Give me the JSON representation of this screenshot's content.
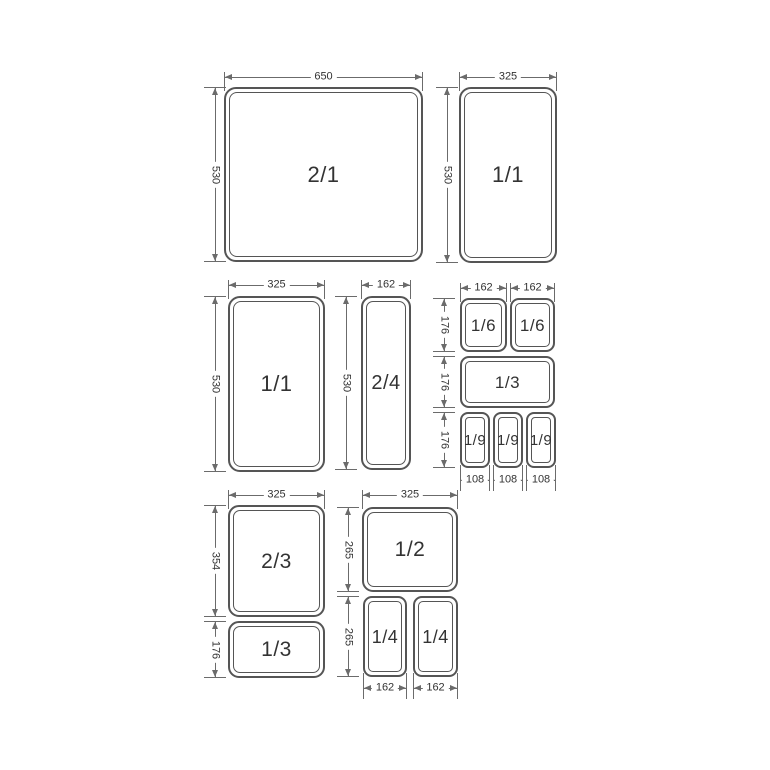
{
  "canvas": {
    "width": 770,
    "height": 770,
    "background": "#ffffff"
  },
  "style": {
    "pan_line_color": "#555555",
    "pan_text_color": "#333333",
    "dim_line_color": "#6b6b6b",
    "dim_text_color": "#333333"
  },
  "pans": [
    {
      "id": "pan-2-1",
      "label": "2/1",
      "x": 224,
      "y": 87,
      "w": 199,
      "h": 175,
      "fs": 22,
      "r": 12
    },
    {
      "id": "pan-1-1-top",
      "label": "1/1",
      "x": 459,
      "y": 87,
      "w": 98,
      "h": 176,
      "fs": 22,
      "r": 12
    },
    {
      "id": "pan-1-1-mid",
      "label": "1/1",
      "x": 228,
      "y": 296,
      "w": 97,
      "h": 176,
      "fs": 22,
      "r": 12
    },
    {
      "id": "pan-2-4",
      "label": "2/4",
      "x": 361,
      "y": 296,
      "w": 50,
      "h": 174,
      "fs": 20,
      "r": 11
    },
    {
      "id": "pan-1-6-a",
      "label": "1/6",
      "x": 460,
      "y": 298,
      "w": 47,
      "h": 54,
      "fs": 17,
      "r": 9
    },
    {
      "id": "pan-1-6-b",
      "label": "1/6",
      "x": 510,
      "y": 298,
      "w": 45,
      "h": 54,
      "fs": 17,
      "r": 9
    },
    {
      "id": "pan-1-3-group",
      "label": "1/3",
      "x": 460,
      "y": 356,
      "w": 95,
      "h": 52,
      "fs": 17,
      "r": 9
    },
    {
      "id": "pan-1-9-a",
      "label": "1/9",
      "x": 460,
      "y": 412,
      "w": 30,
      "h": 56,
      "fs": 15,
      "r": 8
    },
    {
      "id": "pan-1-9-b",
      "label": "1/9",
      "x": 493,
      "y": 412,
      "w": 30,
      "h": 56,
      "fs": 15,
      "r": 8
    },
    {
      "id": "pan-1-9-c",
      "label": "1/9",
      "x": 526,
      "y": 412,
      "w": 30,
      "h": 56,
      "fs": 15,
      "r": 8
    },
    {
      "id": "pan-2-3",
      "label": "2/3",
      "x": 228,
      "y": 505,
      "w": 97,
      "h": 112,
      "fs": 21,
      "r": 11
    },
    {
      "id": "pan-1-3-bottom",
      "label": "1/3",
      "x": 228,
      "y": 621,
      "w": 97,
      "h": 57,
      "fs": 21,
      "r": 11
    },
    {
      "id": "pan-1-2",
      "label": "1/2",
      "x": 362,
      "y": 507,
      "w": 96,
      "h": 85,
      "fs": 21,
      "r": 11
    },
    {
      "id": "pan-1-4-a",
      "label": "1/4",
      "x": 363,
      "y": 596,
      "w": 44,
      "h": 81,
      "fs": 18,
      "r": 9
    },
    {
      "id": "pan-1-4-b",
      "label": "1/4",
      "x": 413,
      "y": 596,
      "w": 45,
      "h": 81,
      "fs": 18,
      "r": 9
    }
  ],
  "h_dims": [
    {
      "label": "650",
      "x1": 224,
      "x2": 423,
      "y": 77,
      "side": "top"
    },
    {
      "label": "325",
      "x1": 459,
      "x2": 557,
      "y": 77,
      "side": "top"
    },
    {
      "label": "325",
      "x1": 228,
      "x2": 325,
      "y": 285,
      "side": "top"
    },
    {
      "label": "162",
      "x1": 361,
      "x2": 411,
      "y": 285,
      "side": "top"
    },
    {
      "label": "162",
      "x1": 460,
      "x2": 507,
      "y": 288,
      "side": "top"
    },
    {
      "label": "162",
      "x1": 510,
      "x2": 555,
      "y": 288,
      "side": "top"
    },
    {
      "label": "108",
      "x1": 460,
      "x2": 490,
      "y": 480,
      "side": "bottom"
    },
    {
      "label": "108",
      "x1": 493,
      "x2": 523,
      "y": 480,
      "side": "bottom"
    },
    {
      "label": "108",
      "x1": 526,
      "x2": 556,
      "y": 480,
      "side": "bottom"
    },
    {
      "label": "325",
      "x1": 228,
      "x2": 325,
      "y": 495,
      "side": "top"
    },
    {
      "label": "325",
      "x1": 362,
      "x2": 458,
      "y": 495,
      "side": "top"
    },
    {
      "label": "162",
      "x1": 363,
      "x2": 407,
      "y": 688,
      "side": "bottom"
    },
    {
      "label": "162",
      "x1": 413,
      "x2": 458,
      "y": 688,
      "side": "bottom"
    }
  ],
  "v_dims": [
    {
      "label": "530",
      "x": 215,
      "y1": 87,
      "y2": 262
    },
    {
      "label": "530",
      "x": 447,
      "y1": 87,
      "y2": 263
    },
    {
      "label": "530",
      "x": 215,
      "y1": 296,
      "y2": 472
    },
    {
      "label": "530",
      "x": 346,
      "y1": 296,
      "y2": 470
    },
    {
      "label": "176",
      "x": 444,
      "y1": 298,
      "y2": 352
    },
    {
      "label": "176",
      "x": 444,
      "y1": 356,
      "y2": 408
    },
    {
      "label": "176",
      "x": 444,
      "y1": 412,
      "y2": 468
    },
    {
      "label": "354",
      "x": 215,
      "y1": 505,
      "y2": 617
    },
    {
      "label": "176",
      "x": 215,
      "y1": 621,
      "y2": 678
    },
    {
      "label": "265",
      "x": 348,
      "y1": 507,
      "y2": 592
    },
    {
      "label": "265",
      "x": 348,
      "y1": 596,
      "y2": 677
    }
  ]
}
